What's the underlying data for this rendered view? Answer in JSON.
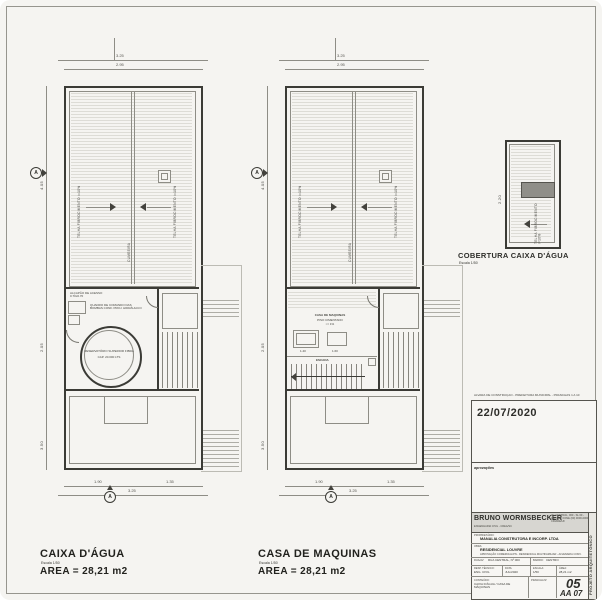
{
  "plan1": {
    "title": "CAIXA D'ÁGUA",
    "scale": "Escala 1/50",
    "area": "AREA = 28,21 m2",
    "roof_label_l": "TELHA FIBROCIMENTO i=10%",
    "roof_label_r": "TELHA FIBROCIMENTO i=10%",
    "ridge_label": "CUMEEIRA",
    "hatch_note": "ALÇAPÃO DE ACESSO 0.70x0.70",
    "equip_note": "QUADRO DE COMANDO DAS BOMBAS CONF. PROJ. HIDRÁULICO",
    "tank_line1": "RESERVATÓRIO SUPERIOR FIBRA",
    "tank_line2": "CAP. 20.000 LTS",
    "marker_letter": "A",
    "dims": {
      "top_total": "3.25",
      "top_inner": "2.95",
      "left_top": "4.05",
      "left_mid": "2.05",
      "left_bot": "3.50",
      "bottom_seg1": "1.90",
      "bottom_seg2": "1.35",
      "bottom_total": "3.25"
    }
  },
  "plan2": {
    "title": "CASA DE MAQUINAS",
    "scale": "Escala 1/50",
    "area": "AREA = 28,21 m2",
    "roof_label_l": "TELHA FIBROCIMENTO i=10%",
    "roof_label_r": "TELHA FIBROCIMENTO i=10%",
    "ridge_label": "CUMEEIRA",
    "room_label": "CASA DE MAQUINAS",
    "room_sub1": "PISO CIMENTADO",
    "room_sub2": "i = 1%",
    "stair_label": "ESCADA",
    "dim_140": "1.40",
    "dim_160": "1.60",
    "marker_letter": "A",
    "dims": {
      "top_total": "3.25",
      "top_inner": "2.95",
      "left_top": "4.05",
      "left_mid": "2.05",
      "left_bot": "3.50",
      "bottom_seg1": "1.90",
      "bottom_seg2": "1.35",
      "bottom_total": "3.25"
    }
  },
  "plan3": {
    "title": "COBERTURA CAIXA D'ÁGUA",
    "scale": "Escala 1/50",
    "arrow_label": "TELHA FIBROCIMENTO i=10%",
    "dim_left": "2.20"
  },
  "titleblock": {
    "top_note": "ALVARÁ DE CONSTRUÇÃO - PREFEITURA MUNICIPAL - PRANCHAS 1 A 10",
    "date": "22/07/2020",
    "approvals_label": "aprovações",
    "firm_name": "BRUNO WORMSBECKER",
    "firm_sub": "ENGENHARIA CIVIL - CREA/SC",
    "firm_info": "AV. CENTRAL, 000 - SL 00 - CENTRO FONE (00) 0000-0000 - CIDADE/UF",
    "owner_label": "PROPRIETÁRIO:",
    "owner": "MANALIA CONSTRUTORA E INCORP. LTDA",
    "work_label": "OBRA:",
    "work": "RESIDENCIAL LOUVRE",
    "work_sub": "APROVAÇÃO COMERCIAL/PN - RESIDENCIAL MULTIFAMILIAR - ALVENARIA CONV.",
    "addr_label": "RUA/AV:",
    "addr": "RUA CENTRAL, Nº 000",
    "district_label": "BAIRRO:",
    "district": "CENTRO",
    "resp_label": "RESP. TÉCNICO:",
    "resp": "ENG. CIVIL",
    "date_label": "DATA:",
    "date_small": "JUL/2020",
    "scale_label": "ESCALA:",
    "scale_small": "1/50",
    "area_label": "ÁREA:",
    "area_small": "28,21 m2",
    "content_label": "CONTEÚDO:",
    "content": "CAIXA D'ÁGUA / CASA DE MÁQUINAS",
    "sheet_label": "PRANCHA Nº",
    "sheet_number": "05",
    "sheet_code": "AA 07",
    "side_text": "PROJETO ARQUITETÔNICO"
  }
}
